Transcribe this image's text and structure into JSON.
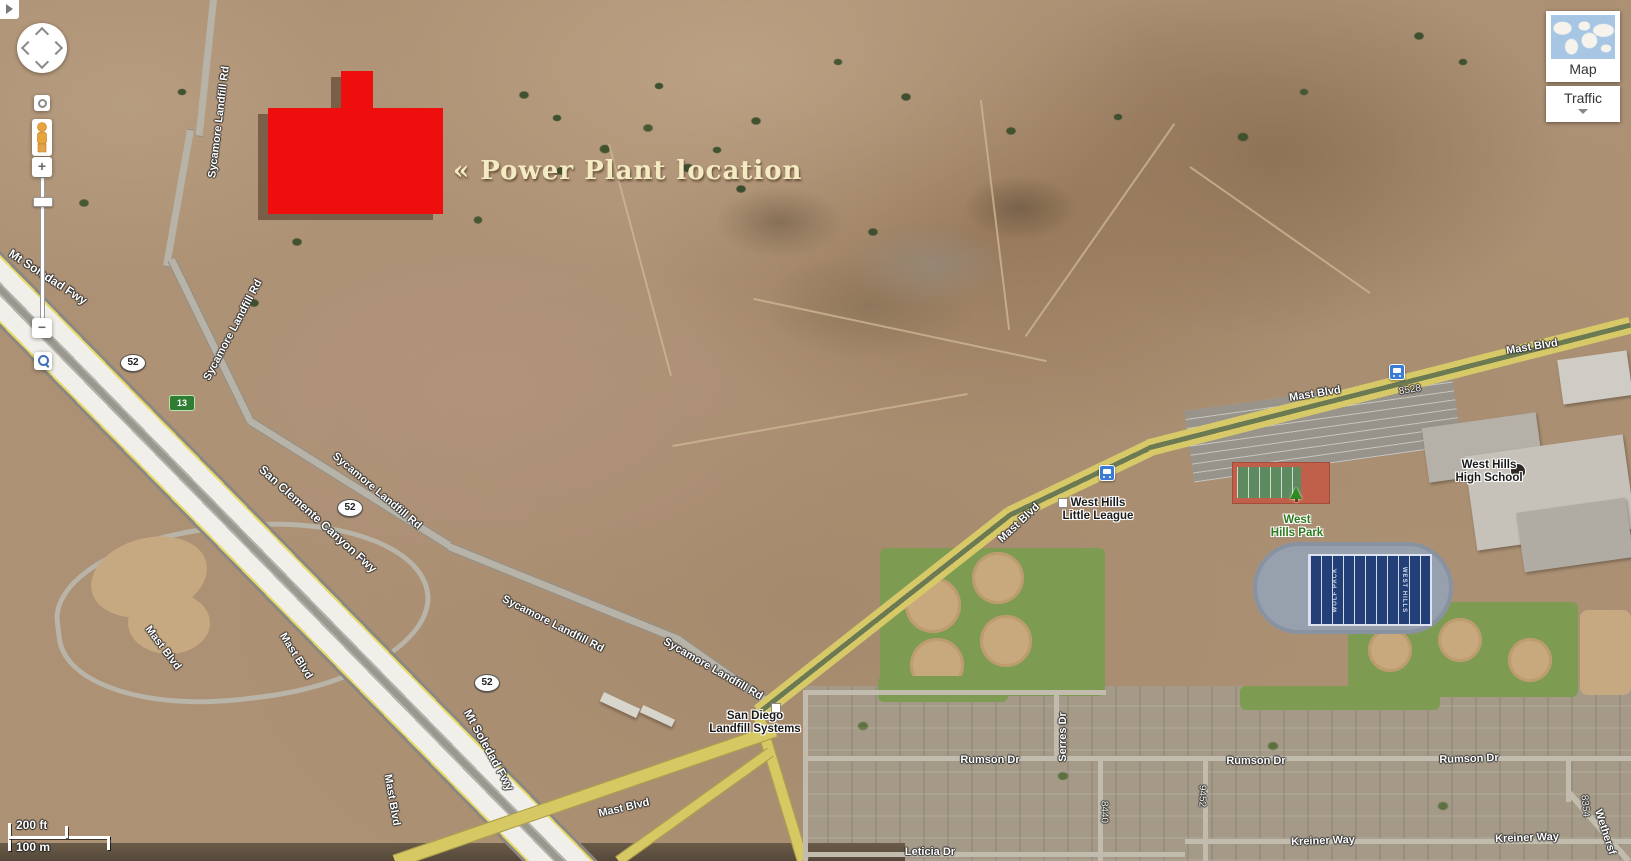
{
  "annotation": {
    "text": "« Power Plant location",
    "shape_color": "#ee0e0e",
    "text_color": "#f4ebc3"
  },
  "view_controls": {
    "map_label": "Map",
    "traffic_label": "Traffic"
  },
  "scale_bar": {
    "imperial": "200 ft",
    "metric": "100 m"
  },
  "football_field": {
    "west_end": "WOLF PACK",
    "east_end": "WEST HILLS"
  },
  "road_labels": [
    {
      "text": "Mt Soledad Fwy",
      "x": 48,
      "y": 277,
      "rot": 33,
      "cls": "fwy"
    },
    {
      "text": "Sycamore Landfill Rd",
      "x": 219,
      "y": 122,
      "rot": -83
    },
    {
      "text": "Sycamore Landfill Rd",
      "x": 233,
      "y": 330,
      "rot": -62
    },
    {
      "text": "Sycamore Landfill Rd",
      "x": 377,
      "y": 491,
      "rot": 40
    },
    {
      "text": "Sycamore Landfill Rd",
      "x": 553,
      "y": 624,
      "rot": 27
    },
    {
      "text": "Sycamore Landfill Rd",
      "x": 713,
      "y": 669,
      "rot": 30
    },
    {
      "text": "San Clemente Canyon Fwy",
      "x": 318,
      "y": 519,
      "rot": 42,
      "cls": "fwy"
    },
    {
      "text": "Mt Soledad Fwy",
      "x": 489,
      "y": 750,
      "rot": 61,
      "cls": "fwy"
    },
    {
      "text": "Mast Blvd",
      "x": 163,
      "y": 648,
      "rot": 53
    },
    {
      "text": "Mast Blvd",
      "x": 296,
      "y": 656,
      "rot": 58
    },
    {
      "text": "Mast Blvd",
      "x": 392,
      "y": 800,
      "rot": 80
    },
    {
      "text": "Mast Blvd",
      "x": 624,
      "y": 808,
      "rot": -13
    },
    {
      "text": "Mast Blvd",
      "x": 1019,
      "y": 523,
      "rot": -43
    },
    {
      "text": "Mast Blvd",
      "x": 1315,
      "y": 394,
      "rot": -9
    },
    {
      "text": "Mast Blvd",
      "x": 1532,
      "y": 347,
      "rot": -9
    },
    {
      "text": "Rumson Dr",
      "x": 990,
      "y": 760,
      "rot": 0
    },
    {
      "text": "Rumson Dr",
      "x": 1256,
      "y": 761,
      "rot": 0
    },
    {
      "text": "Rumson Dr",
      "x": 1469,
      "y": 759,
      "rot": -2
    },
    {
      "text": "Kreiner Way",
      "x": 1323,
      "y": 841,
      "rot": -2
    },
    {
      "text": "Kreiner Way",
      "x": 1527,
      "y": 838,
      "rot": -2
    },
    {
      "text": "Leticia Dr",
      "x": 930,
      "y": 852,
      "rot": 0
    },
    {
      "text": "Serres Dr",
      "x": 1063,
      "y": 737,
      "rot": -90
    },
    {
      "text": "Wethersf",
      "x": 1605,
      "y": 832,
      "rot": 72
    },
    {
      "text": "8528",
      "x": 1410,
      "y": 390,
      "rot": -9,
      "cls": "num"
    },
    {
      "text": "8440",
      "x": 1104,
      "y": 812,
      "rot": 90,
      "cls": "num"
    },
    {
      "text": "9452",
      "x": 1202,
      "y": 796,
      "rot": 90,
      "cls": "num"
    },
    {
      "text": "8354",
      "x": 1585,
      "y": 806,
      "rot": 85,
      "cls": "num"
    }
  ],
  "poi_labels": [
    {
      "lines": [
        "San Diego",
        "Landfill Systems"
      ],
      "x": 755,
      "y": 723,
      "cls": "dark"
    },
    {
      "lines": [
        "West Hills",
        "Little League"
      ],
      "x": 1098,
      "y": 510,
      "cls": "dark"
    },
    {
      "lines": [
        "West Hills",
        "High School"
      ],
      "x": 1489,
      "y": 472,
      "cls": "dark"
    },
    {
      "lines": [
        "West",
        "Hills Park"
      ],
      "x": 1297,
      "y": 527,
      "cls": "green"
    }
  ],
  "route_shields": [
    {
      "text": "52",
      "x": 133,
      "y": 363
    },
    {
      "text": "52",
      "x": 350,
      "y": 508
    },
    {
      "text": "52",
      "x": 487,
      "y": 683
    }
  ],
  "exit_badge": {
    "text": "13",
    "x": 182,
    "y": 403
  },
  "transit_stops": [
    {
      "x": 1397,
      "y": 372
    },
    {
      "x": 1107,
      "y": 473
    }
  ],
  "poi_markers": [
    {
      "x": 776,
      "y": 708
    },
    {
      "x": 1063,
      "y": 503
    }
  ]
}
